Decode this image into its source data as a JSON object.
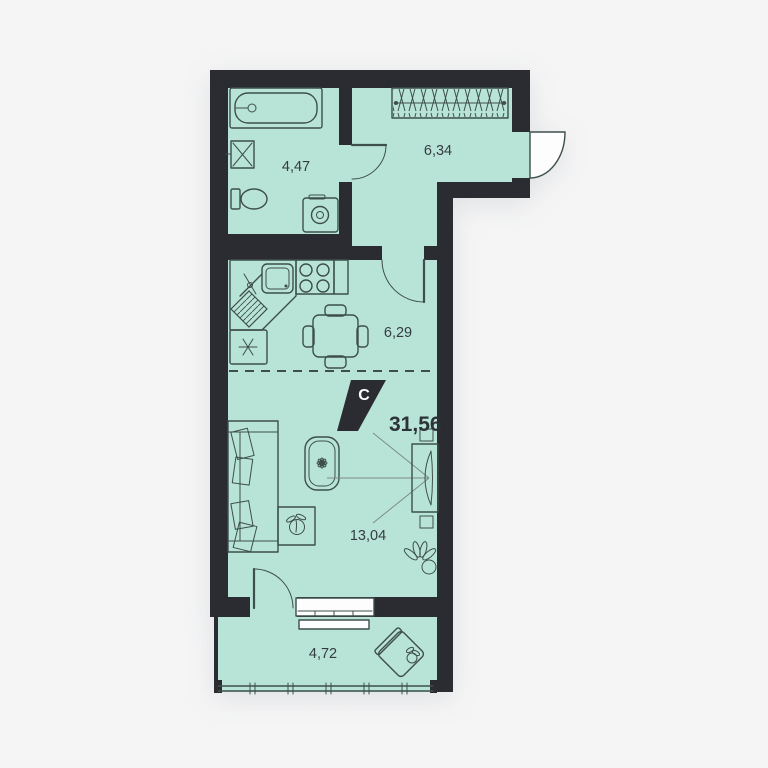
{
  "plan": {
    "type": "apartment-floor-plan",
    "rooms": [
      {
        "id": "bathroom",
        "area": "4,47"
      },
      {
        "id": "hallway",
        "area": "6,34"
      },
      {
        "id": "kitchen",
        "area": "6,29"
      },
      {
        "id": "living-room",
        "area": "13,04"
      },
      {
        "id": "balcony",
        "area": "4,72"
      }
    ],
    "labels": {
      "total_area": "31,56",
      "north_marker": "C"
    },
    "icons": [
      "bathtub-icon",
      "washbasin-icon",
      "toilet-icon",
      "washing-machine-icon",
      "wardrobe-icon",
      "kitchen-sink-icon",
      "stove-icon",
      "fridge-icon",
      "dining-table-icon",
      "sofa-icon",
      "side-table-icon",
      "rug-icon",
      "tv-icon",
      "plant-icon",
      "armchair-icon",
      "north-marker-icon",
      "entrance-door",
      "interior-door",
      "window"
    ],
    "colors": {
      "background": "#f5f5f6",
      "floor": "#b8e4d7",
      "walls": "#2b2c31",
      "furniture_line": "#3e4e4b",
      "label_text": "#363b40",
      "north_flag": "#2b2c31",
      "north_letter": "#ffffff"
    }
  }
}
